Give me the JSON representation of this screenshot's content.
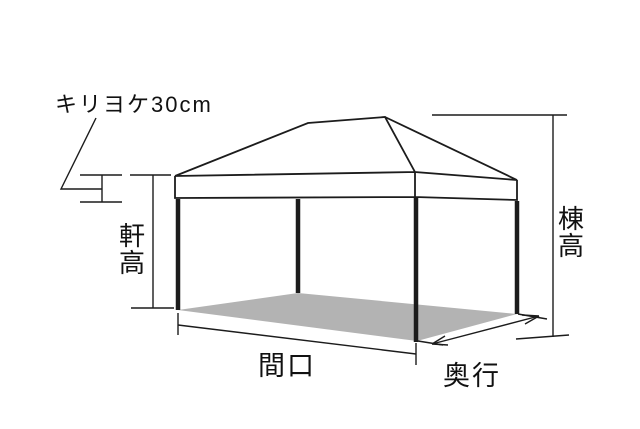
{
  "diagram": {
    "type": "tent-dimension-diagram",
    "labels": {
      "valance": "キリヨケ30cm",
      "eave_height": "軒高",
      "ridge_height": "棟高",
      "frontage": "間口",
      "depth": "奥行"
    },
    "colors": {
      "line": "#1c1c1c",
      "floor": "#b3b3b3",
      "background": "#ffffff"
    }
  }
}
